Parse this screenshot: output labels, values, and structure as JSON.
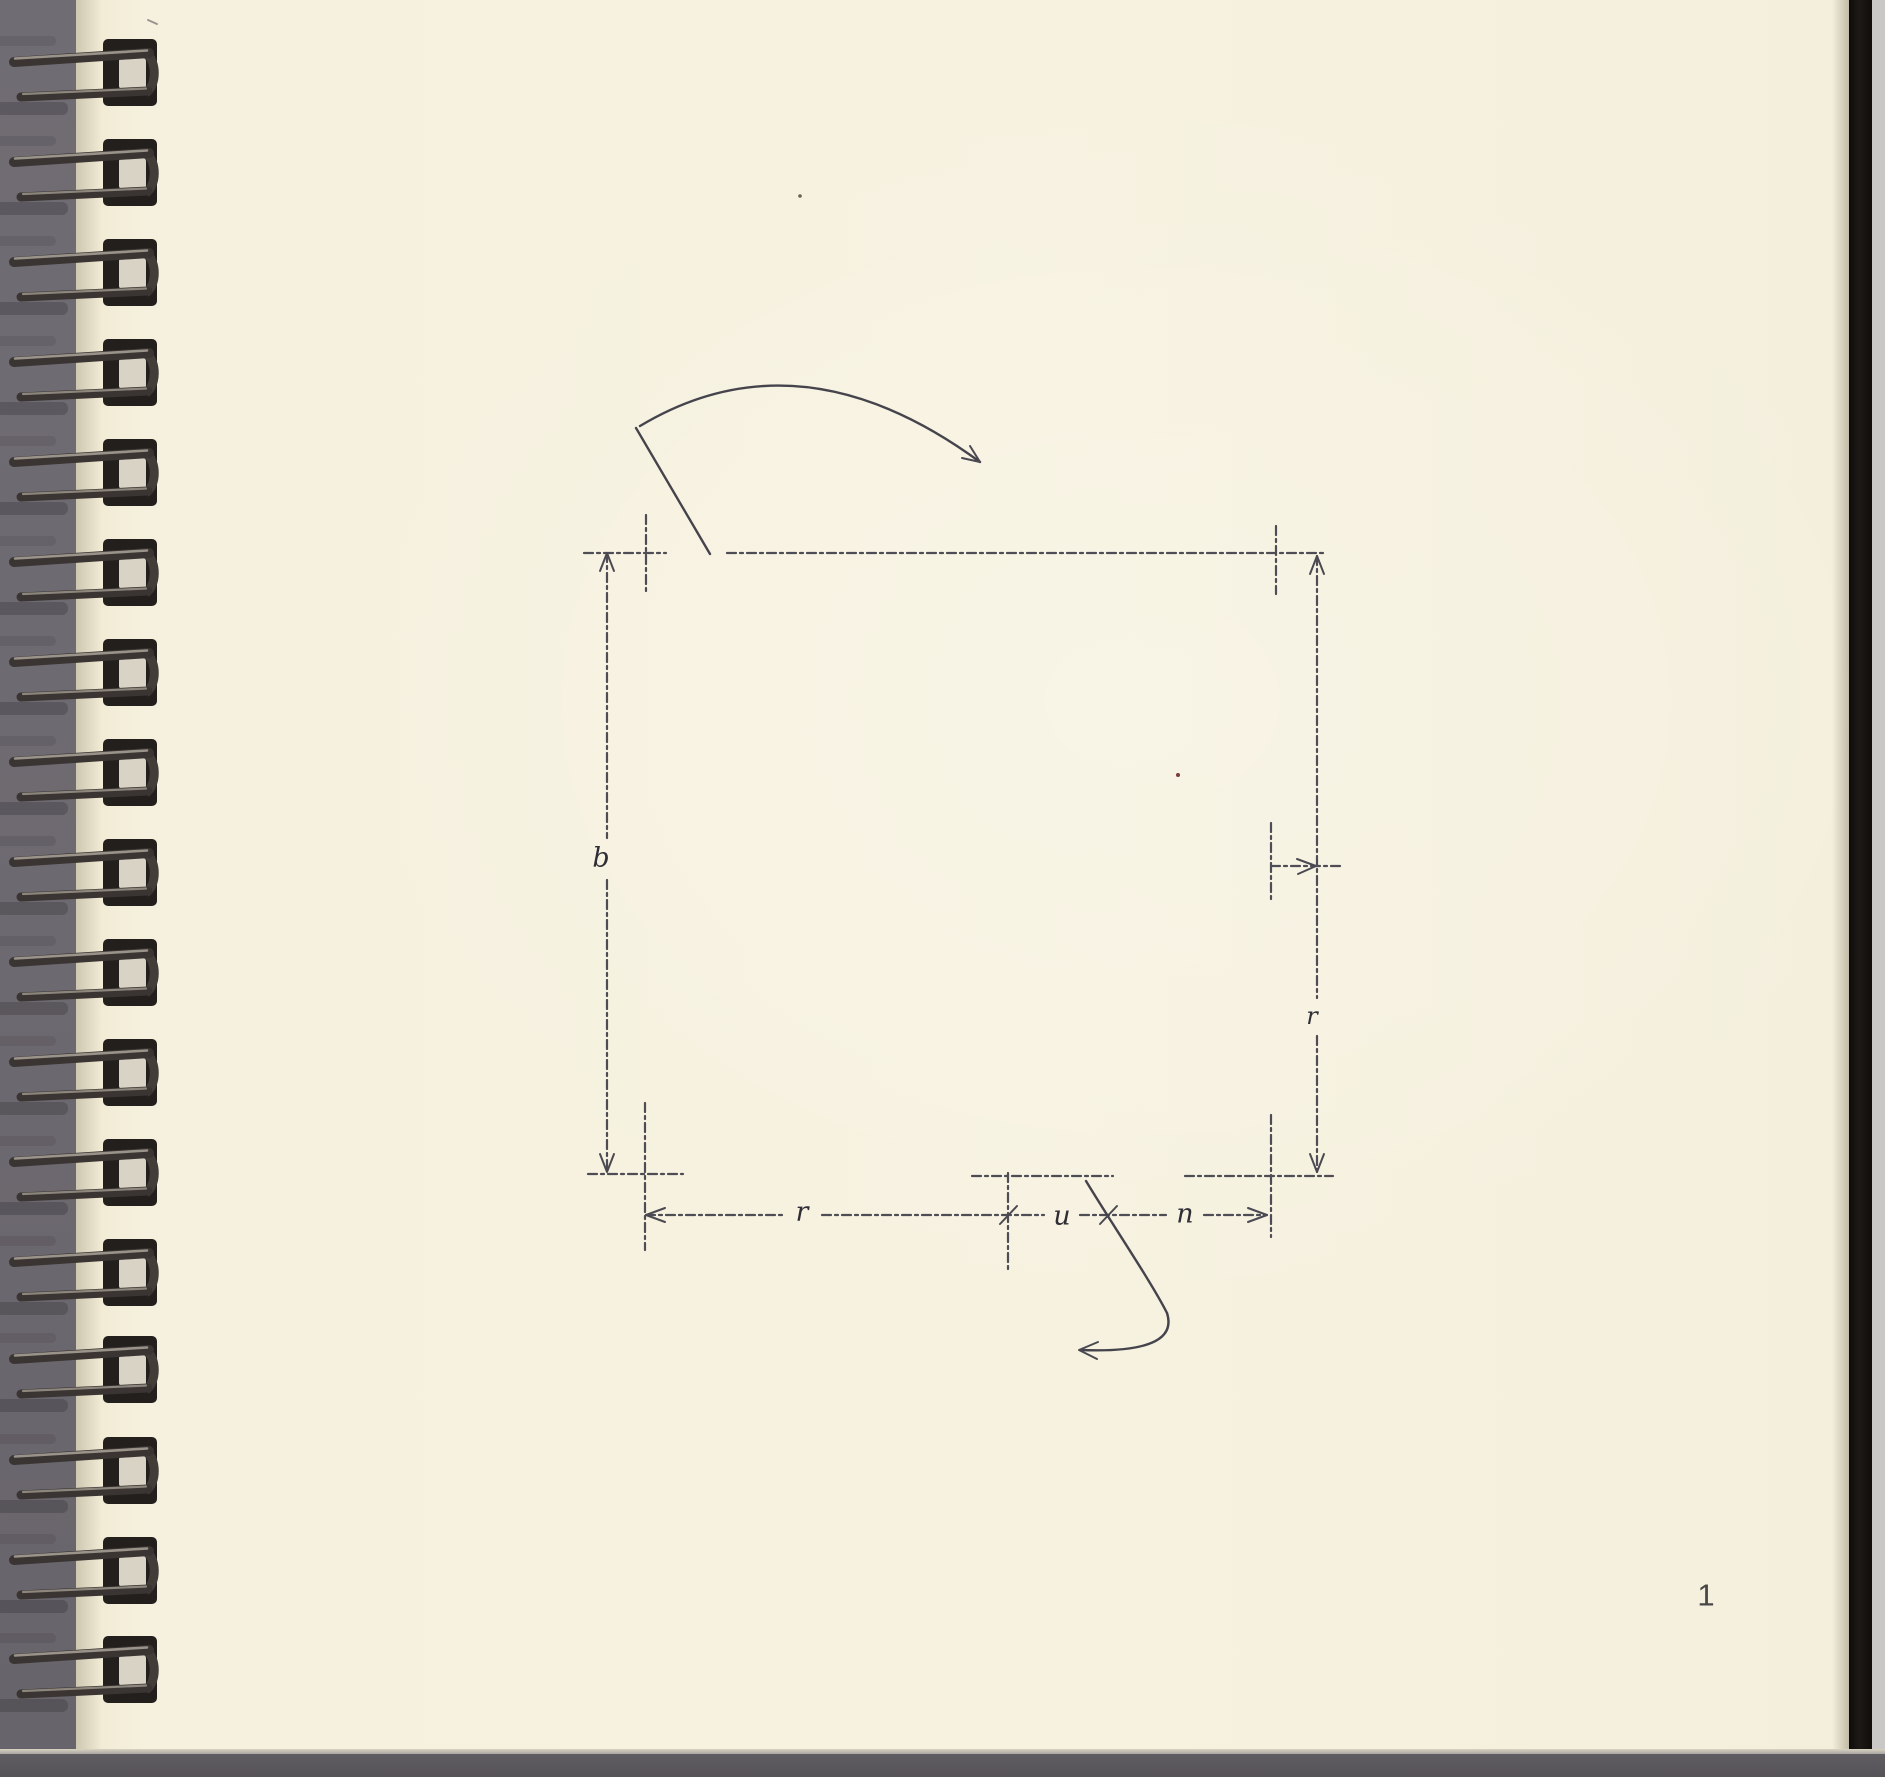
{
  "document": {
    "type": "scanned spiral-bound sketchbook page with hand-drawn dimensioned plan diagram",
    "page_number": "1"
  },
  "diagram": {
    "shape": "square plan outline (dashed) with door-swing arcs at top-left and bottom openings",
    "dimension_labels": {
      "left_height": "b",
      "right_lower_height": "r",
      "bottom_left_width": "r",
      "bottom_opening_width": "u",
      "bottom_right_width": "n"
    }
  },
  "colors": {
    "paper": "#f7f2e0",
    "scanner_background_left": "#6e6a71",
    "scanner_background_bottom": "#59565b",
    "scanner_background_right_edge": "#c9c8c6",
    "cover_edge_black": "#161310",
    "ink": "#4e4d55",
    "spiral_wire_dark": "#3a3533",
    "spiral_wire_highlight": "#9a938a"
  }
}
